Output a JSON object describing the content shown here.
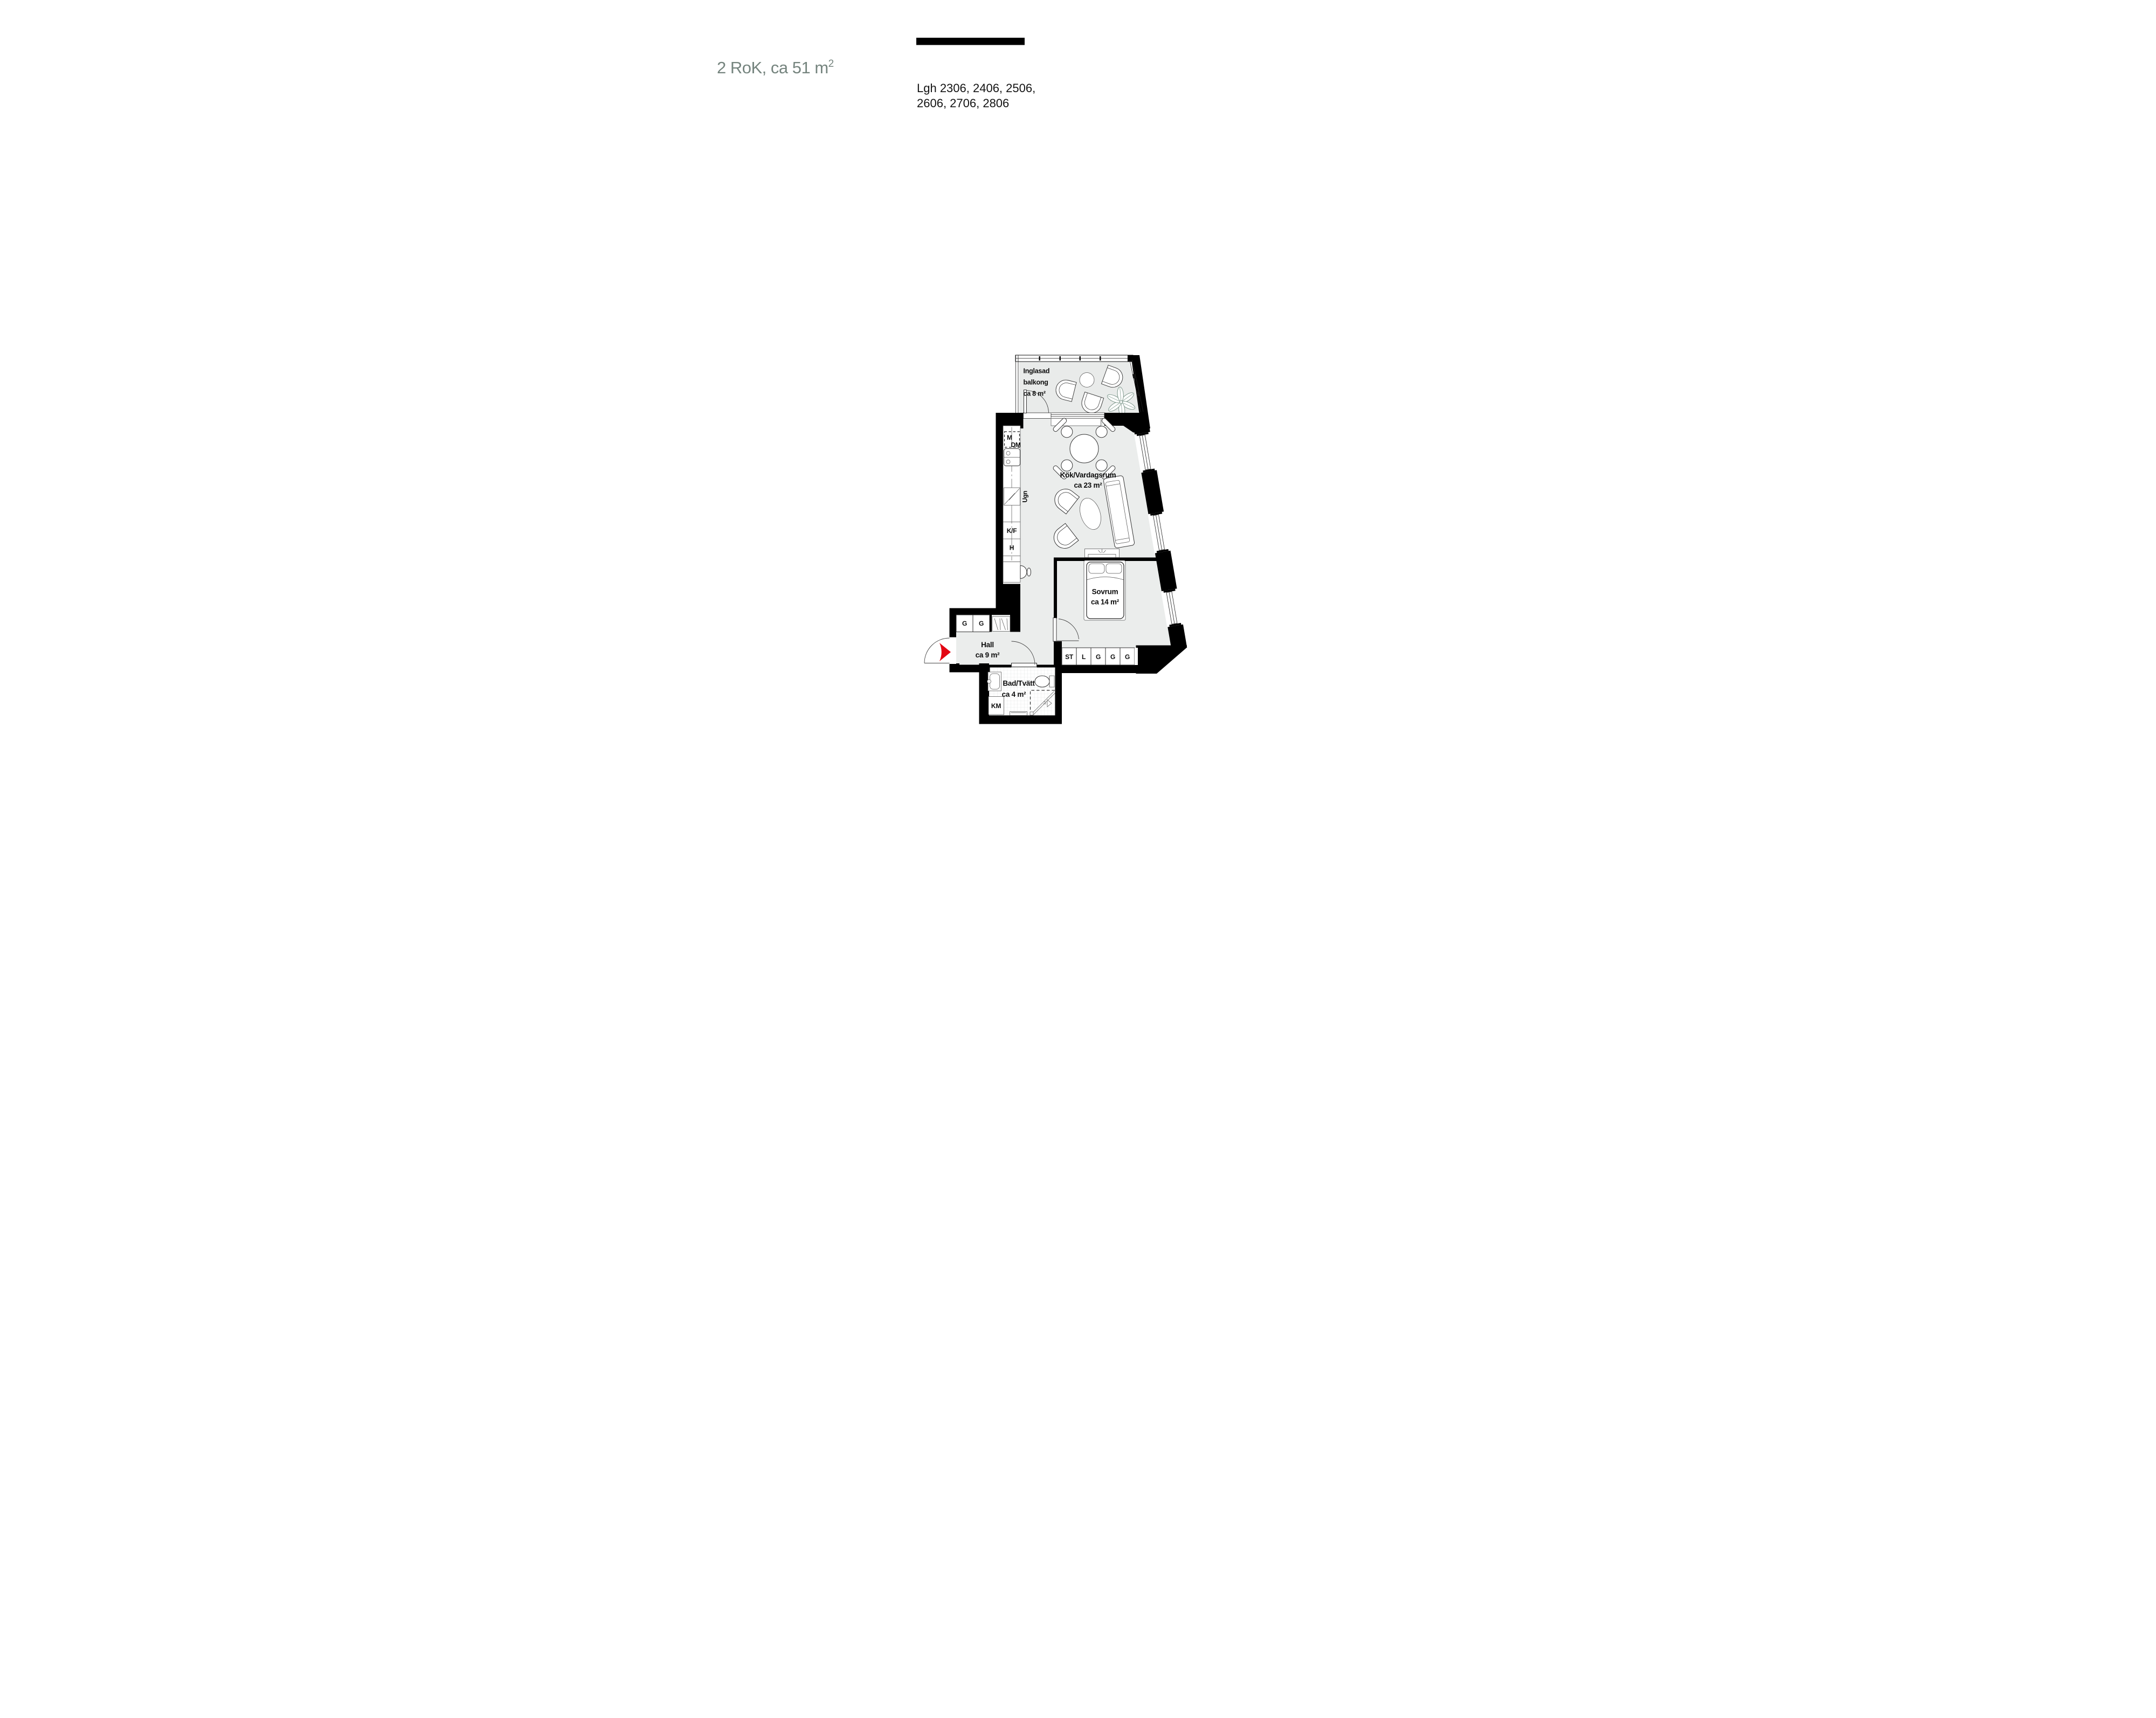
{
  "header": {
    "title_main": "2 RoK, ca 51 m",
    "title_sup": "2",
    "units_line1": "Lgh 2306, 2406, 2506,",
    "units_line2": "2606, 2706, 2806"
  },
  "rooms": {
    "balcony": {
      "line1": "Inglasad",
      "line2": "balkong",
      "line3": "ca 8 m²"
    },
    "kitchen_living": {
      "name": "Kök/Vardagsrum",
      "area": "ca 23 m²"
    },
    "bedroom": {
      "name": "Sovrum",
      "area": "ca 14 m²"
    },
    "hall": {
      "name": "Hall",
      "area": "ca 9 m²"
    },
    "bath": {
      "name": "Bad/Tvätt",
      "area": "ca 4 m²"
    }
  },
  "appliances": {
    "microwave": "M",
    "dishwasher": "DM",
    "oven": "Ugn",
    "fridge_freezer": "K/F",
    "tall_cabinet": "H",
    "washing_machine": "KM"
  },
  "closets": {
    "hall": [
      "G",
      "G"
    ],
    "bedroom": [
      "ST",
      "L",
      "G",
      "G",
      "G"
    ]
  },
  "colors": {
    "title": "#75847e",
    "wall": "#000000",
    "floor": "#ebedec",
    "balcony_floor": "#e9ebea",
    "entry_arrow": "#e30613",
    "plant": "#7f998d"
  }
}
